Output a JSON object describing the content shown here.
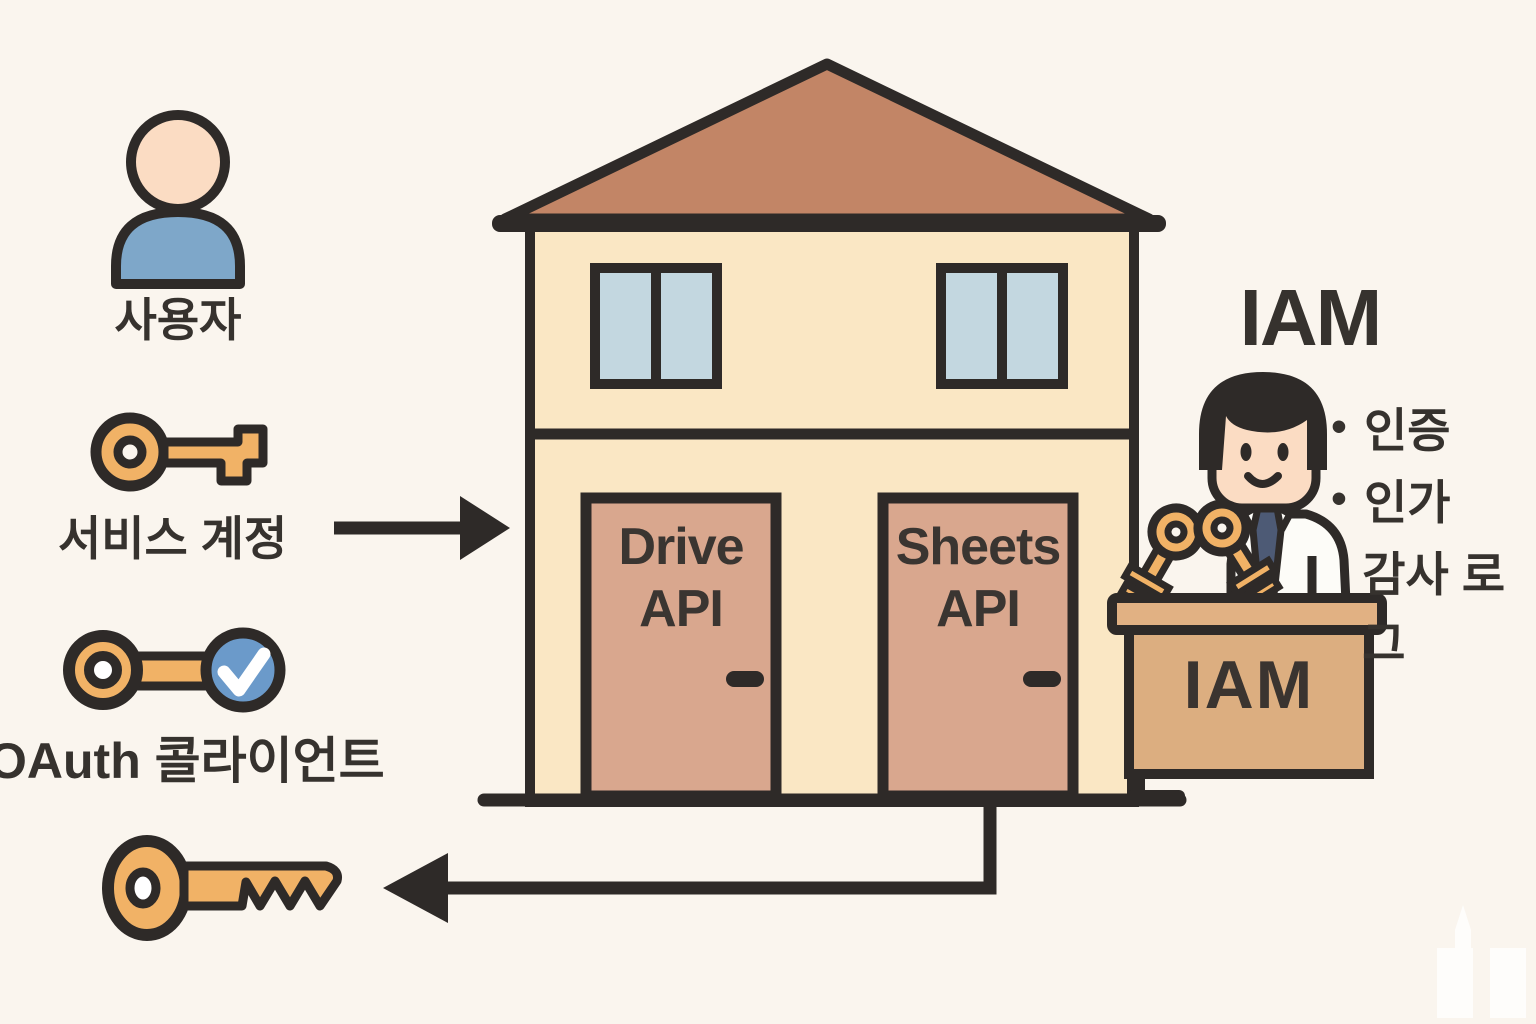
{
  "colors": {
    "background": "#FAF5EE",
    "outline": "#2E2A28",
    "roof": "#C28566",
    "wall": "#FAE7C4",
    "window_glass": "#C3D7E0",
    "door": "#D9A78E",
    "key_gold": "#F1B266",
    "user_body_blue": "#7EA7C9",
    "check_blue": "#6B9ACA",
    "desk_wood": "#DFAE7D",
    "skin": "#FBDCC3",
    "tie_navy": "#4D5A75",
    "text_dark": "#36322E"
  },
  "left_panel": {
    "user": {
      "icon": "person-icon",
      "label": "사용자"
    },
    "service_account": {
      "icon": "key-icon",
      "label": "서비스 계정"
    },
    "oauth_client": {
      "icon": "key-check-icon",
      "label": "OAuth 콜라이언트"
    },
    "returned_key": {
      "icon": "key-icon"
    }
  },
  "house": {
    "doors": [
      {
        "label": "Drive\nAPI"
      },
      {
        "label": "Sheets\nAPI"
      }
    ]
  },
  "iam": {
    "title": "IAM",
    "desk_label": "IAM",
    "features": [
      {
        "bullet": "•",
        "label": "인증"
      },
      {
        "bullet": "•",
        "label": "인가"
      },
      {
        "bullet": "",
        "label": "감사 로그"
      }
    ]
  }
}
